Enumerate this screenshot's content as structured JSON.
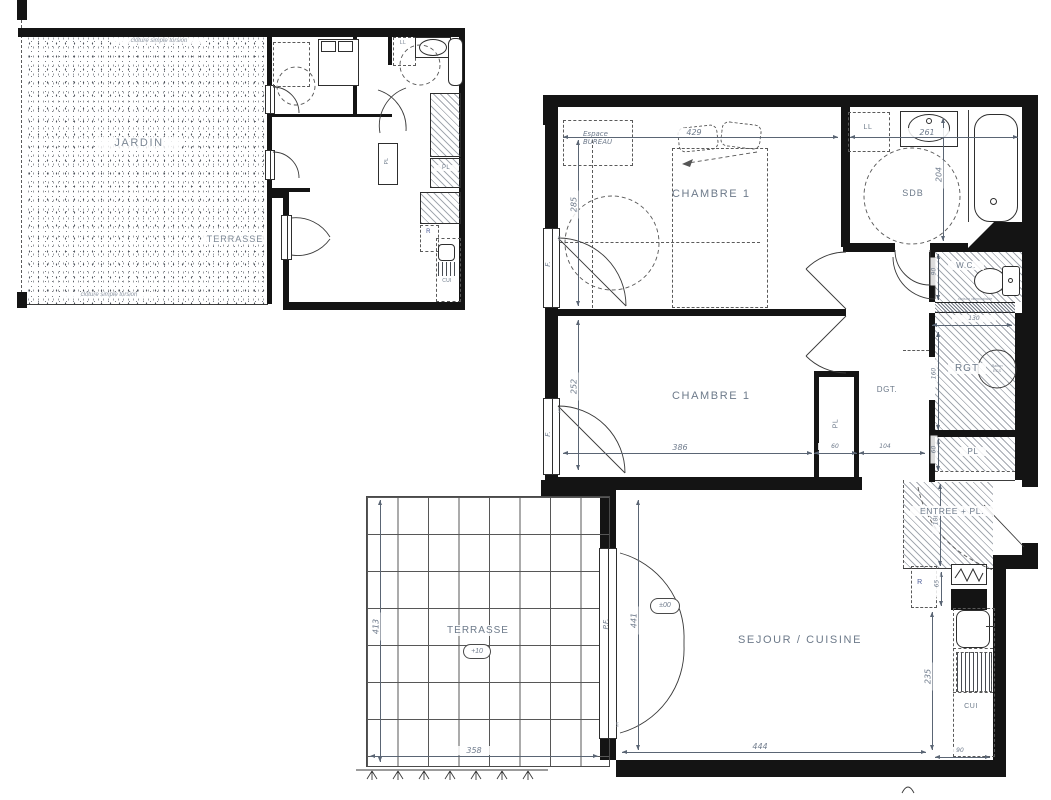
{
  "plan": {
    "small": {
      "jardin": "JARDIN",
      "terrasse": "TERRASSE",
      "fence_top": "clôture simple torsion",
      "fence_bottom": "clôture simple torsion",
      "ll": "LL",
      "pl_rot": "PL",
      "pl": "PL",
      "r": "R",
      "cui": "CUI"
    },
    "main": {
      "chambre1": "CHAMBRE 1",
      "bureau1": "Espace",
      "bureau2": "BUREAU",
      "sdb": "SDB",
      "ll": "LL",
      "wc": "W.C.",
      "note": "cloison démontable",
      "rgt": "RGT",
      "ballon1": "Ballon",
      "ballon2": "ECS",
      "pl_right": "PL",
      "chambre2": "CHAMBRE 1",
      "dgt": "DGT.",
      "pl_closet": "PL",
      "entree": "ENTREE + PL.",
      "r": "R",
      "cui": "CUI",
      "sejour": "SEJOUR / CUISINE",
      "terrasse": "TERRASSE",
      "lvl_terrasse": "+10",
      "lvl_sejour": "±00",
      "f1": "F.",
      "f2": "F.",
      "pf": "P.F.",
      "vr1": "VR",
      "vr2": "VR",
      "vr3": "VR",
      "dims": {
        "d429": "429",
        "d285": "285",
        "d261": "261",
        "d204": "204",
        "d90_wc": "90",
        "d130": "130",
        "d160": "160",
        "d60_pl": "60",
        "d252": "252",
        "d386": "386",
        "d60_closet": "60",
        "d104": "104",
        "d186": "186",
        "d65": "65",
        "d235": "235",
        "d90_cui": "90",
        "d441": "441",
        "d444": "444",
        "d413": "413",
        "d358": "358"
      }
    }
  }
}
